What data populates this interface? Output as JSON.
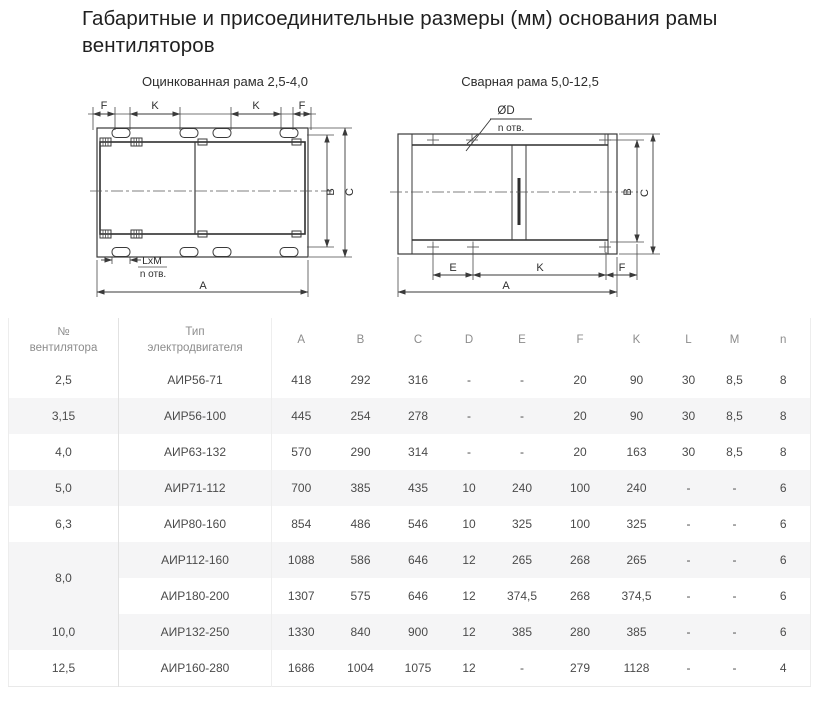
{
  "page": {
    "title": "Габаритные и присоединительные размеры (мм) основания рамы\nвентиляторов"
  },
  "figures": {
    "left": {
      "caption": "Оцинкованная рама 2,5-4,0",
      "labels": {
        "f1": "F",
        "k1": "K",
        "k2": "K",
        "f2": "F",
        "b": "B",
        "c": "C",
        "a": "A",
        "lxm": "LxM",
        "n_otv": "n отв."
      }
    },
    "right": {
      "caption": "Сварная рама 5,0-12,5",
      "labels": {
        "dd": "ØD",
        "n_otv": "n отв.",
        "e": "E",
        "k": "K",
        "f": "F",
        "b": "B",
        "c": "C",
        "a": "A"
      }
    }
  },
  "table": {
    "headers": {
      "fan_no": "№\nвентилятора",
      "motor_type": "Тип\nэлектродвигателя"
    },
    "dim_headers": [
      "A",
      "B",
      "C",
      "D",
      "E",
      "F",
      "K",
      "L",
      "M",
      "n"
    ],
    "rows": [
      {
        "no": "2,5",
        "rowspan": 1,
        "type": "АИР56-71",
        "values": [
          "418",
          "292",
          "316",
          "-",
          "-",
          "20",
          "90",
          "30",
          "8,5",
          "8"
        ]
      },
      {
        "no": "3,15",
        "rowspan": 1,
        "type": "АИР56-100",
        "values": [
          "445",
          "254",
          "278",
          "-",
          "-",
          "20",
          "90",
          "30",
          "8,5",
          "8"
        ]
      },
      {
        "no": "4,0",
        "rowspan": 1,
        "type": "АИР63-132",
        "values": [
          "570",
          "290",
          "314",
          "-",
          "-",
          "20",
          "163",
          "30",
          "8,5",
          "8"
        ]
      },
      {
        "no": "5,0",
        "rowspan": 1,
        "type": "АИР71-112",
        "values": [
          "700",
          "385",
          "435",
          "10",
          "240",
          "100",
          "240",
          "-",
          "-",
          "6"
        ]
      },
      {
        "no": "6,3",
        "rowspan": 1,
        "type": "АИР80-160",
        "values": [
          "854",
          "486",
          "546",
          "10",
          "325",
          "100",
          "325",
          "-",
          "-",
          "6"
        ]
      },
      {
        "no": "8,0",
        "rowspan": 2,
        "type": "АИР112-160",
        "values": [
          "1088",
          "586",
          "646",
          "12",
          "265",
          "268",
          "265",
          "-",
          "-",
          "6"
        ]
      },
      {
        "no": null,
        "rowspan": 0,
        "type": "АИР180-200",
        "values": [
          "1307",
          "575",
          "646",
          "12",
          "374,5",
          "268",
          "374,5",
          "-",
          "-",
          "6"
        ]
      },
      {
        "no": "10,0",
        "rowspan": 1,
        "type": "АИР132-250",
        "values": [
          "1330",
          "840",
          "900",
          "12",
          "385",
          "280",
          "385",
          "-",
          "-",
          "6"
        ]
      },
      {
        "no": "12,5",
        "rowspan": 1,
        "type": "АИР160-280",
        "values": [
          "1686",
          "1004",
          "1075",
          "12",
          "-",
          "279",
          "1128",
          "-",
          "-",
          "4"
        ]
      }
    ]
  }
}
